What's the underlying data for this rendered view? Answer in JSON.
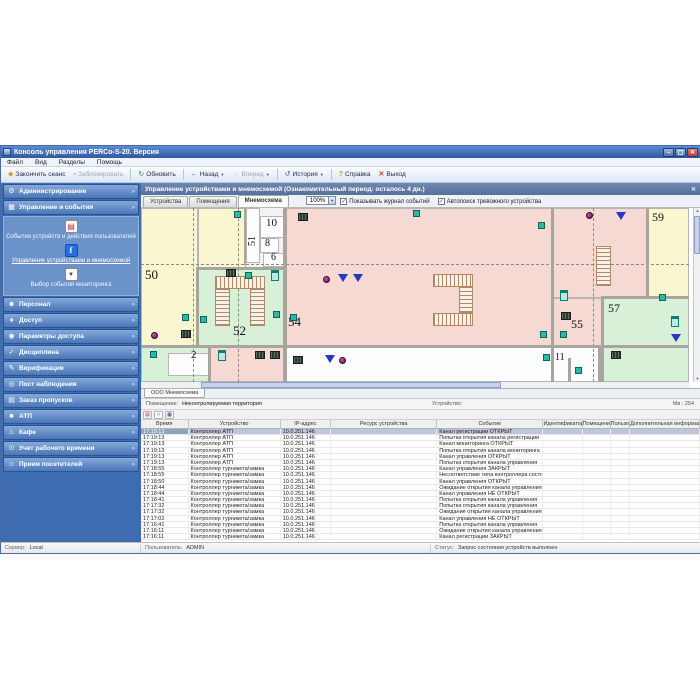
{
  "window": {
    "title": "Консоль управления PERCo-S-20. Версия",
    "buttons": {
      "min": "–",
      "max": "▢",
      "close": "✕"
    }
  },
  "menu": [
    "Файл",
    "Вид",
    "Разделы",
    "Помощь"
  ],
  "toolbar": [
    {
      "label": "Закончить сеанс",
      "icon": "session"
    },
    {
      "label": "Заблокировать",
      "icon": "lock",
      "disabled": true
    },
    {
      "label": "Обновить",
      "icon": "refresh",
      "sep": true
    },
    {
      "label": "Назад",
      "icon": "back",
      "arrow": true,
      "sep": true
    },
    {
      "label": "Вперед",
      "icon": "forward",
      "arrow": true,
      "disabled": true
    },
    {
      "label": "История",
      "icon": "history",
      "arrow": true,
      "sep": true
    },
    {
      "label": "Справка",
      "icon": "help",
      "sep": true
    },
    {
      "label": "Выход",
      "icon": "exit"
    }
  ],
  "sidebar": {
    "sections": [
      {
        "label": "Администрирование",
        "icon": "gear"
      },
      {
        "label": "Управление и события",
        "icon": "events",
        "expanded": true
      },
      {
        "label": "Персонал",
        "icon": "person"
      },
      {
        "label": "Доступ",
        "icon": "key"
      },
      {
        "label": "Параметры доступа",
        "icon": "params"
      },
      {
        "label": "Дисциплина",
        "icon": "discipline"
      },
      {
        "label": "Верификация",
        "icon": "verify"
      },
      {
        "label": "Пост наблюдения",
        "icon": "watch"
      },
      {
        "label": "Заказ пропусков",
        "icon": "pass"
      },
      {
        "label": "АТП",
        "icon": "atp"
      },
      {
        "label": "Кафе",
        "icon": "cafe"
      },
      {
        "label": "Учет рабочего времени",
        "icon": "time"
      },
      {
        "label": "Прием посетителей",
        "icon": "visitors"
      }
    ],
    "submenu": [
      {
        "label": "События устройств и действия пользователей",
        "icon": "log"
      },
      {
        "label": "Управление устройствами и мнемосхемой",
        "icon": "control",
        "active": true
      },
      {
        "label": "Выбор событий мониторинга",
        "icon": "monitor"
      }
    ]
  },
  "panel": {
    "title": "Управление устройствами и мнемосхемой (Ознакомительный период: осталось 4 дн.)",
    "tabs": [
      "Устройства",
      "Помещения",
      "Мнемосхема"
    ],
    "active_tab": "Мнемосхема",
    "zoom": "100%",
    "show_log": "Показывать журнал событий",
    "autosearch": "Автопоиск тревожного устройства"
  },
  "map": {
    "tab": "ООО Мнемосхема",
    "room_label": "Помещение:",
    "room_value": "Неконтролируемая территория",
    "device_label": "Устройство:",
    "scale_info": "Мв : 254",
    "rooms": [
      {
        "x": 0,
        "y": 0,
        "w": 57,
        "h": 139,
        "c": "yellow",
        "label": "50",
        "lx": 4,
        "ly": 60,
        "fs": 13
      },
      {
        "x": 57,
        "y": 0,
        "w": 48,
        "h": 61,
        "c": "yellow"
      },
      {
        "x": 105,
        "y": 0,
        "w": 14,
        "h": 55,
        "c": "white",
        "label": "51",
        "lx": 107,
        "ly": 38,
        "fs": 10,
        "rot": true
      },
      {
        "x": 119,
        "y": 8,
        "w": 25,
        "h": 22,
        "c": "white",
        "label": "10",
        "lx": 125,
        "ly": 10,
        "fs": 11
      },
      {
        "x": 119,
        "y": 30,
        "w": 19,
        "h": 15,
        "c": "white",
        "label": "8",
        "lx": 124,
        "ly": 31,
        "fs": 10
      },
      {
        "x": 122,
        "y": 45,
        "w": 22,
        "h": 14,
        "c": "white",
        "label": "6",
        "lx": 130,
        "ly": 45,
        "fs": 10
      },
      {
        "x": 57,
        "y": 61,
        "w": 87,
        "h": 78,
        "c": "green",
        "label": "52",
        "lx": 92,
        "ly": 116,
        "fs": 13
      },
      {
        "x": 144,
        "y": 0,
        "w": 268,
        "h": 139,
        "c": "pink",
        "label": "54",
        "lx": 147,
        "ly": 107,
        "fs": 13
      },
      {
        "x": 412,
        "y": 0,
        "w": 95,
        "h": 90,
        "c": "pink"
      },
      {
        "x": 412,
        "y": 90,
        "w": 50,
        "h": 49,
        "c": "pink",
        "label": "55",
        "lx": 430,
        "ly": 110,
        "fs": 12
      },
      {
        "x": 507,
        "y": 0,
        "w": 41,
        "h": 90,
        "c": "yellow",
        "label": "59",
        "lx": 511,
        "ly": 3,
        "fs": 12
      },
      {
        "x": 462,
        "y": 90,
        "w": 86,
        "h": 84,
        "c": "green",
        "label": "57",
        "lx": 467,
        "ly": 94,
        "fs": 12
      },
      {
        "x": 0,
        "y": 139,
        "w": 69,
        "h": 35,
        "c": "green",
        "label": "2",
        "lx": 50,
        "ly": 142,
        "fs": 11
      },
      {
        "x": 69,
        "y": 139,
        "w": 75,
        "h": 35,
        "c": "pink"
      },
      {
        "x": 144,
        "y": 139,
        "w": 268,
        "h": 35,
        "c": "white"
      },
      {
        "x": 412,
        "y": 139,
        "w": 47,
        "h": 35,
        "c": "white",
        "label": "11",
        "lx": 414,
        "ly": 145,
        "fs": 10
      },
      {
        "x": 27,
        "y": 145,
        "w": 42,
        "h": 23,
        "c": "white"
      }
    ],
    "devices": [
      {
        "t": "reader",
        "x": 93,
        "y": 3
      },
      {
        "t": "reader",
        "x": 272,
        "y": 2
      },
      {
        "t": "reader",
        "x": 397,
        "y": 14
      },
      {
        "t": "reader",
        "x": 104,
        "y": 64
      },
      {
        "t": "reader",
        "x": 41,
        "y": 106
      },
      {
        "t": "reader",
        "x": 59,
        "y": 108
      },
      {
        "t": "reader",
        "x": 132,
        "y": 103
      },
      {
        "t": "reader",
        "x": 149,
        "y": 106
      },
      {
        "t": "reader",
        "x": 518,
        "y": 86
      },
      {
        "t": "reader",
        "x": 399,
        "y": 123
      },
      {
        "t": "reader",
        "x": 419,
        "y": 123
      },
      {
        "t": "reader",
        "x": 9,
        "y": 143
      },
      {
        "t": "reader",
        "x": 402,
        "y": 146
      },
      {
        "t": "reader",
        "x": 434,
        "y": 159
      },
      {
        "t": "door",
        "x": 130,
        "y": 62
      },
      {
        "t": "door",
        "x": 419,
        "y": 82
      },
      {
        "t": "door",
        "x": 77,
        "y": 142
      },
      {
        "t": "door",
        "x": 530,
        "y": 108
      },
      {
        "t": "turnstile",
        "x": 157,
        "y": 5
      },
      {
        "t": "turnstile",
        "x": 85,
        "y": 61
      },
      {
        "t": "turnstile",
        "x": 40,
        "y": 122
      },
      {
        "t": "turnstile",
        "x": 420,
        "y": 104
      },
      {
        "t": "turnstile",
        "x": 114,
        "y": 143
      },
      {
        "t": "turnstile",
        "x": 129,
        "y": 143
      },
      {
        "t": "turnstile",
        "x": 152,
        "y": 148
      },
      {
        "t": "turnstile",
        "x": 470,
        "y": 143
      },
      {
        "t": "camera",
        "x": 10,
        "y": 124
      },
      {
        "t": "camera",
        "x": 182,
        "y": 68
      },
      {
        "t": "camera",
        "x": 445,
        "y": 4
      },
      {
        "t": "camera",
        "x": 198,
        "y": 149
      },
      {
        "t": "funnel",
        "x": 197,
        "y": 66
      },
      {
        "t": "funnel",
        "x": 212,
        "y": 66
      },
      {
        "t": "funnel",
        "x": 475,
        "y": 4
      },
      {
        "t": "funnel",
        "x": 530,
        "y": 126
      },
      {
        "t": "funnel",
        "x": 184,
        "y": 147
      }
    ]
  },
  "log": {
    "columns": [
      "Время",
      "Устройство",
      "IP-адрес",
      "Ресурс устройства",
      "Событие",
      "Идентификатор",
      "Помещение",
      "Пользователь",
      "Дополнительная информация"
    ],
    "rows": [
      [
        "17:19:13",
        "Контроллер АТП",
        "10.0.251.146",
        "",
        "Канал регистрации ОТКРЫТ"
      ],
      [
        "17:19:13",
        "Контроллер АТП",
        "10.0.251.146",
        "",
        "Попытка открытия канала регистрации"
      ],
      [
        "17:19:13",
        "Контроллер АТП",
        "10.0.251.146",
        "",
        "Канал мониторинга ОТКРЫТ"
      ],
      [
        "17:19:13",
        "Контроллер АТП",
        "10.0.251.146",
        "",
        "Попытка открытия канала мониторинга"
      ],
      [
        "17:19:13",
        "Контроллер АТП",
        "10.0.251.146",
        "",
        "Канал управления ОТКРЫТ"
      ],
      [
        "17:19:13",
        "Контроллер АТП",
        "10.0.251.146",
        "",
        "Попытка открытия канала управления"
      ],
      [
        "17:18:55",
        "Контроллер турникета/замка",
        "10.0.251.146",
        "",
        "Канал управления ЗАКРЫТ"
      ],
      [
        "17:18:55",
        "Контроллер турникета/замка",
        "10.0.251.146",
        "",
        "Несоответствие типа контроллера состоянию"
      ],
      [
        "17:18:50",
        "Контроллер турникета/замка",
        "10.0.251.146",
        "",
        "Канал управления ОТКРЫТ"
      ],
      [
        "17:18:44",
        "Контроллер турникета/замка",
        "10.0.251.146",
        "",
        "Ожидание открытия канала управления"
      ],
      [
        "17:18:44",
        "Контроллер турникета/замка",
        "10.0.251.146",
        "",
        "Канал управления НЕ ОТКРЫТ"
      ],
      [
        "17:18:41",
        "Контроллер турникета/замка",
        "10.0.251.146",
        "",
        "Попытка открытия канала управления"
      ],
      [
        "17:17:32",
        "Контроллер турникета/замка",
        "10.0.251.146",
        "",
        "Попытка открытия канала управления"
      ],
      [
        "17:17:32",
        "Контроллер турникета/замка",
        "10.0.251.146",
        "",
        "Ожидание открытия канала управления"
      ],
      [
        "17:17:02",
        "Контроллер турникета/замка",
        "10.0.251.146",
        "",
        "Канал управления НЕ ОТКРЫТ"
      ],
      [
        "17:16:41",
        "Контроллер турникета/замка",
        "10.0.251.146",
        "",
        "Попытка открытия канала управления"
      ],
      [
        "17:16:11",
        "Контроллер турникета/замка",
        "10.0.251.146",
        "",
        "Ожидание открытия канала управления"
      ],
      [
        "17:16:11",
        "Контроллер турникета/замка",
        "10.0.251.146",
        "",
        "Канал регистрации ЗАКРЫТ"
      ]
    ]
  },
  "statusbar": {
    "server_label": "Сервер:",
    "server": "Local",
    "user_label": "Пользователь:",
    "user": "ADMIN",
    "status_label": "Статус:",
    "status": "Запрос состояния устройств выполнен"
  }
}
